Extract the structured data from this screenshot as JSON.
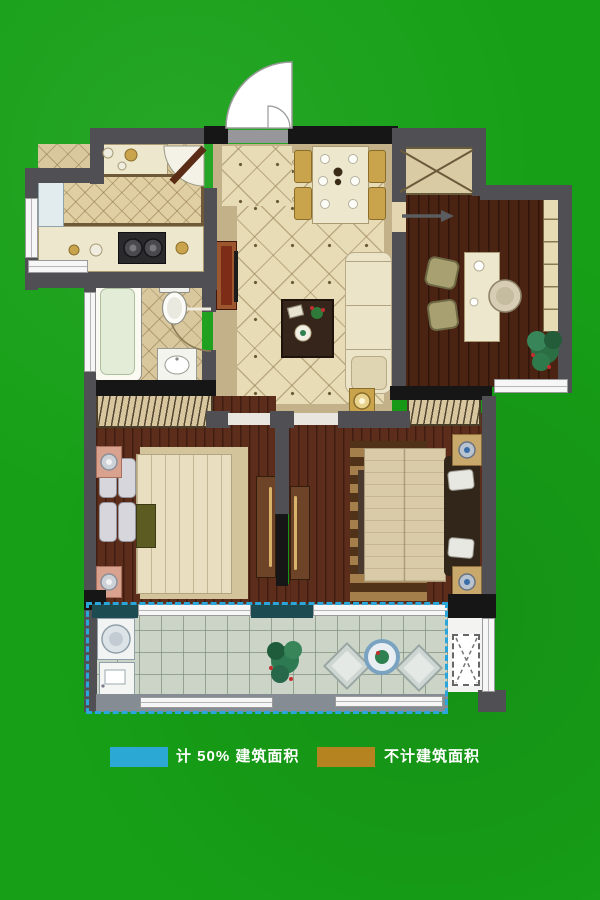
{
  "colors": {
    "green-bg": "#17a017",
    "wall-gray": "#505054",
    "wall-black": "#161616",
    "teal-wall": "#1d4b52",
    "sill-gray": "#858c93",
    "window-white": "#f6f6f6",
    "tile-floor": "#e8dcb6",
    "tile-border": "#c3b189",
    "kitchen-tile": "#d9c89e",
    "wood-study": "#4a2313",
    "wood-bedroom": "#5c2d1b",
    "balcony-floor": "#cbd4c6",
    "counter-cream": "#ece7cd",
    "wardrobe-bg": "#d7c69e",
    "door-brown": "#6e4428",
    "dash-blue": "#2ba6da",
    "legend-blue": "#2ba9d4",
    "legend-gold": "#b5831f"
  },
  "legend": {
    "items": [
      {
        "label": "计 50% 建筑面积",
        "color_key": "legend-blue"
      },
      {
        "label": "不计建筑面积",
        "color_key": "legend-gold"
      }
    ]
  },
  "icons": {
    "entry-arrow": "→",
    "flue-shaft": "X-crossed box",
    "ac-platform": "dashed X box",
    "door-swing": "quarter-circle arc"
  }
}
